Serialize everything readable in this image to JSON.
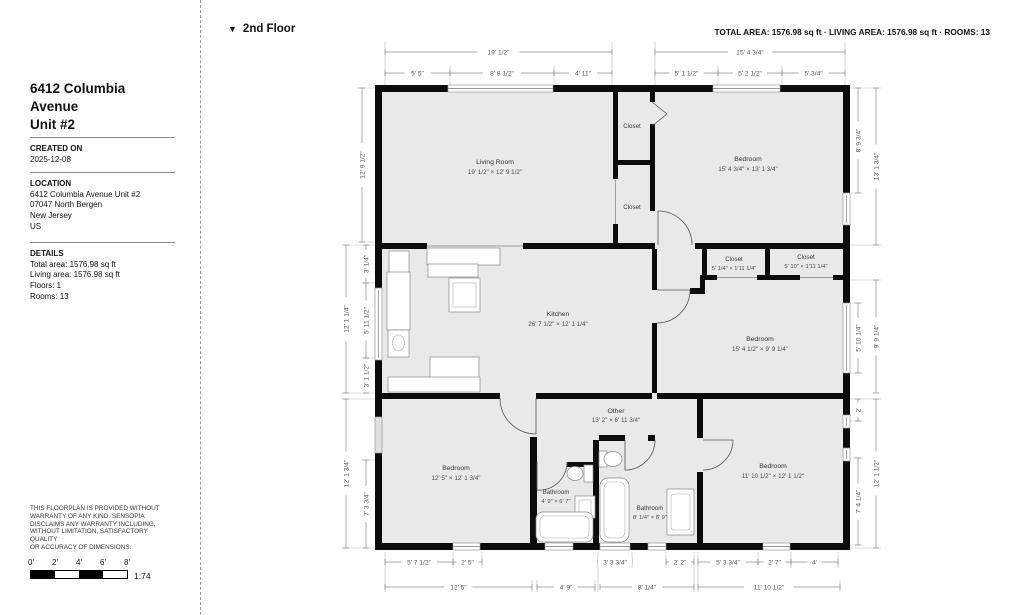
{
  "header": {
    "floor_icon": "▼",
    "floor_label": "2nd Floor",
    "stats": "TOTAL AREA: 1576.98 sq ft · LIVING AREA: 1576.98 sq ft · ROOMS: 13"
  },
  "sidebar": {
    "title_line1": "6412 Columbia Avenue",
    "title_line2": "Unit #2",
    "created": {
      "label": "CREATED ON",
      "value": "2025-12-08"
    },
    "location": {
      "label": "LOCATION",
      "lines": [
        "6412 Columbia Avenue Unit #2",
        "07047 North Bergen",
        "New Jersey",
        "US"
      ]
    },
    "details": {
      "label": "DETAILS",
      "lines": [
        "Total area: 1576.98 sq ft",
        "Living area: 1576.98 sq ft",
        "Floors: 1",
        "Rooms: 13"
      ]
    },
    "disclaimer_lines": [
      "THIS FLOORPLAN IS PROVIDED WITHOUT",
      "WARRANTY OF ANY KIND. SENSOPIA",
      "DISCLAIMS ANY WARRANTY INCLUDING,",
      "WITHOUT LIMITATION, SATISFACTORY QUALITY",
      "OR ACCURACY OF DIMENSIONS."
    ],
    "scale": {
      "ticks": [
        "0'",
        "2'",
        "4'",
        "6'",
        "8'"
      ],
      "ratio": "1:74"
    }
  },
  "rooms": {
    "living": {
      "name": "Living Room",
      "size": "19' 1/2\" × 12' 9 1/2\""
    },
    "closet_top": {
      "name": "Closet"
    },
    "closet_mid": {
      "name": "Closet"
    },
    "bedroom_tr": {
      "name": "Bedroom",
      "size": "15' 4 3/4\" × 13' 1 3/4\""
    },
    "closet_a": {
      "name": "Closet",
      "size": "5' 1/4\" × 1'11 1/4\""
    },
    "closet_b": {
      "name": "Closet",
      "size": "5' 10\" × 1'11 1/4\""
    },
    "kitchen": {
      "name": "Kitchen",
      "size": "26' 7 1/2\" × 12' 1 1/4\""
    },
    "bedroom_mr": {
      "name": "Bedroom",
      "size": "15' 4 1/2\" × 9' 9 1/4\""
    },
    "bedroom_bl": {
      "name": "Bedroom",
      "size": "12' 5\" × 12' 1 3/4\""
    },
    "other": {
      "name": "Other",
      "size": "13' 2\" × 6' 11 3/4\""
    },
    "bathroom_a": {
      "name": "Bathroom",
      "size": "4' 9\" × 6' 7\""
    },
    "bathroom_b": {
      "name": "Bathroom",
      "size": "8' 1/4\" × 8' 9\""
    },
    "bedroom_br": {
      "name": "Bedroom",
      "size": "11' 10 1/2\" × 12' 1 1/2\""
    }
  },
  "dims": {
    "top": [
      "19' 1/2\"",
      "5' 5\"",
      "8' 8 1/2\"",
      "4' 11\"",
      "15' 4 3/4\"",
      "5' 1 1/2\"",
      "5' 2 1/2\"",
      "5' 3/4\""
    ],
    "left": [
      "12' 9 1/2\"",
      "12' 1 1/4\"",
      "3' 1/4\"",
      "5' 11 1/2\"",
      "3' 1 1/2\"",
      "12' 1 3/4\"",
      "7' 3 3/4\""
    ],
    "right": [
      "8' 9 3/4\"",
      "13' 1 3/4\"",
      "5' 10 1/4\"",
      "9' 9 1/4\"",
      "2'",
      "7' 4 1/4\"",
      "12' 1 1/2\""
    ],
    "bottom": [
      "5' 7 1/2\"",
      "2' 5\"",
      "3' 3 3/4\"",
      "2' 2\"",
      "5' 3 3/4\"",
      "2' 7\"",
      "4'",
      "12' 5\"",
      "4' 9\"",
      "8' 1/4\"",
      "11' 10 1/2\""
    ]
  },
  "colors": {
    "wall": "#0c0c0c",
    "room_fill": "#e9e9e9",
    "dim_text": "#555555"
  }
}
